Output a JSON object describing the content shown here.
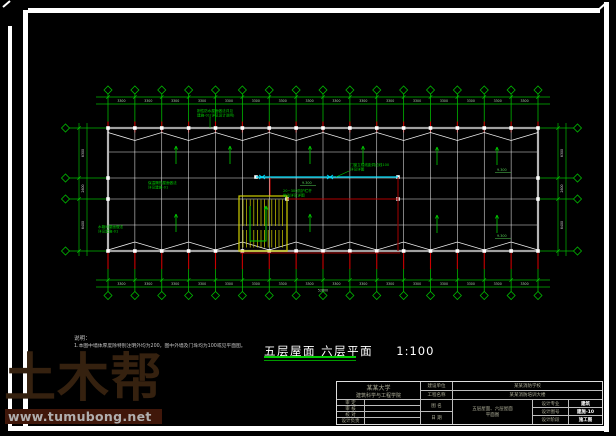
{
  "watermark": {
    "brand": "土木帮",
    "url": "www.tumubong.net"
  },
  "notes": {
    "heading": "说明：",
    "line1": "1.本图中墙体厚度除特别注明外均为200，图中外墙及门垛均为100或见平面图。"
  },
  "title": {
    "name": "五层屋面 六层平面",
    "scale": "1:100"
  },
  "dims": {
    "bay": "3300",
    "left": [
      "6300",
      "2600",
      "6400"
    ],
    "total": "52800"
  },
  "levels": {
    "roof": "9.300"
  },
  "annotations": [
    {
      "lines": [
        "刚性防水屋面做法详见",
        "建施-01(详见设计说明)"
      ]
    },
    {
      "lines": [
        "保温隔热屋面做法",
        "详见建施-01"
      ]
    },
    {
      "lines": [
        "20~300防护栏杆",
        "做法详见详图"
      ]
    },
    {
      "lines": [
        "门窗立樘线距洞边线100",
        "详见详图"
      ]
    },
    {
      "lines": [
        "水箱间屋面做法",
        "详见建施-01"
      ]
    }
  ],
  "titleblock": {
    "school_line1": "某某大学",
    "school_line2": "建筑科学与工程学院",
    "info_rows": [
      {
        "label": "建设单位",
        "value": "某某消防学校"
      },
      {
        "label": "工程名称",
        "value": "某某消防培训大楼"
      }
    ],
    "sign_rows": [
      {
        "label": "审 定"
      },
      {
        "label": "审 核"
      },
      {
        "label": "校 对"
      },
      {
        "label": "设计负责"
      }
    ],
    "mid_rows": [
      {
        "label": "图 名"
      },
      {
        "label": "日 期"
      }
    ],
    "drawing_name_line1": "五层屋面、六层屋面",
    "drawing_name_line2": "平面图",
    "spec_rows": [
      {
        "label": "设计专业",
        "value": "建筑"
      },
      {
        "label": "设计图号",
        "value": "建施-10"
      },
      {
        "label": "设计阶段",
        "value": "施工图"
      }
    ]
  }
}
